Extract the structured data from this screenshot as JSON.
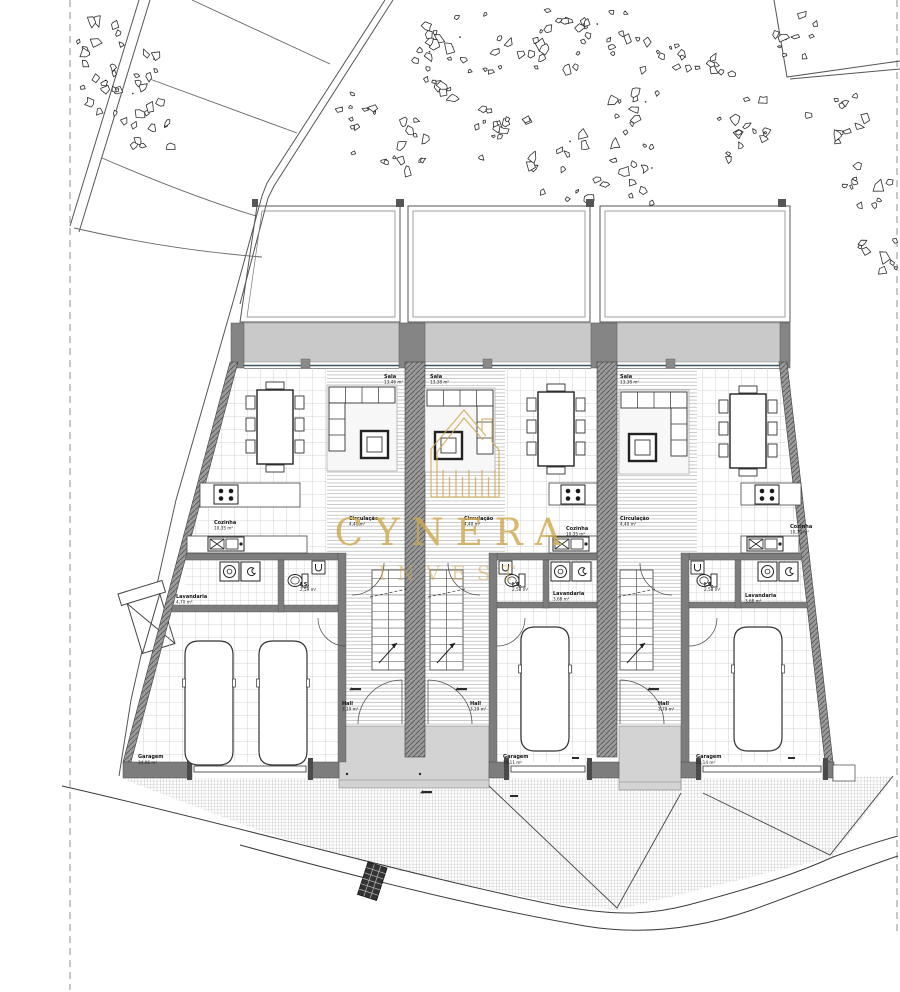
{
  "watermark": {
    "brand": "CYNERA",
    "sub": "INVEST",
    "color_gold": "#d0a84f"
  },
  "colors": {
    "wall": "#7d7d7d",
    "wall_dark": "#4a4a4a",
    "terrace": "#c9c9c9",
    "porch": "#d3d3d3",
    "floor_line": "#c6c6c6",
    "site_line": "#555555",
    "glazing": "#3a5560",
    "driveway_line": "#a3a3a3",
    "leaf_stroke": "#2e2e2e"
  },
  "units": [
    {
      "id": "unit-1",
      "rooms": {
        "sala": {
          "label": "Sala",
          "area": "13,46 m²"
        },
        "cozinha": {
          "label": "Cozinha",
          "area": "10,35 m²"
        },
        "circulacao": {
          "label": "Circulação",
          "area": "4,40 m²"
        },
        "is": {
          "label": "I.S.",
          "area": "2,59 m²"
        },
        "lavandaria": {
          "label": "Lavandaria",
          "area": "4,70 m²"
        },
        "garagem": {
          "label": "Garagem",
          "area": "34,06 m²"
        },
        "hall": {
          "label": "Hall",
          "area": "3,19 m²"
        }
      }
    },
    {
      "id": "unit-2",
      "rooms": {
        "sala": {
          "label": "Sala",
          "area": "13,38 m²"
        },
        "cozinha": {
          "label": "Cozinha",
          "area": "10,35 m²"
        },
        "circulacao": {
          "label": "Circulação",
          "area": "4,40 m²"
        },
        "is": {
          "label": "I.S.",
          "area": "2,58 m²"
        },
        "lavandaria": {
          "label": "Lavandaria",
          "area": "3,68 m²"
        },
        "garagem": {
          "label": "Garagem",
          "area": "19,11 m²"
        },
        "hall": {
          "label": "Hall",
          "area": "3,19 m²"
        }
      }
    },
    {
      "id": "unit-3",
      "rooms": {
        "sala": {
          "label": "Sala",
          "area": "13,38 m²"
        },
        "cozinha": {
          "label": "Cozinha",
          "area": "10,70 m²"
        },
        "circulacao": {
          "label": "Circulação",
          "area": "4,40 m²"
        },
        "is": {
          "label": "I.S.",
          "area": "2,58 m²"
        },
        "lavandaria": {
          "label": "Lavandaria",
          "area": "3,68 m²"
        },
        "garagem": {
          "label": "Garagem",
          "area": "20,14 m²"
        },
        "hall": {
          "label": "Hall",
          "area": "3,79 m²"
        }
      }
    }
  ],
  "decor": {
    "leaf_clusters": [
      [
        118,
        80,
        52,
        26
      ],
      [
        95,
        35,
        25,
        8
      ],
      [
        155,
        130,
        28,
        10
      ],
      [
        390,
        140,
        42,
        16
      ],
      [
        355,
        105,
        22,
        7
      ],
      [
        470,
        55,
        55,
        26
      ],
      [
        555,
        35,
        45,
        20
      ],
      [
        610,
        30,
        30,
        10
      ],
      [
        500,
        140,
        40,
        14
      ],
      [
        575,
        165,
        45,
        18
      ],
      [
        640,
        120,
        38,
        14
      ],
      [
        665,
        60,
        28,
        9
      ],
      [
        745,
        130,
        40,
        14
      ],
      [
        712,
        65,
        25,
        8
      ],
      [
        800,
        35,
        30,
        10
      ],
      [
        838,
        115,
        35,
        12
      ],
      [
        868,
        190,
        30,
        10
      ],
      [
        882,
        250,
        26,
        9
      ],
      [
        640,
        185,
        25,
        8
      ],
      [
        438,
        45,
        22,
        7
      ]
    ]
  }
}
